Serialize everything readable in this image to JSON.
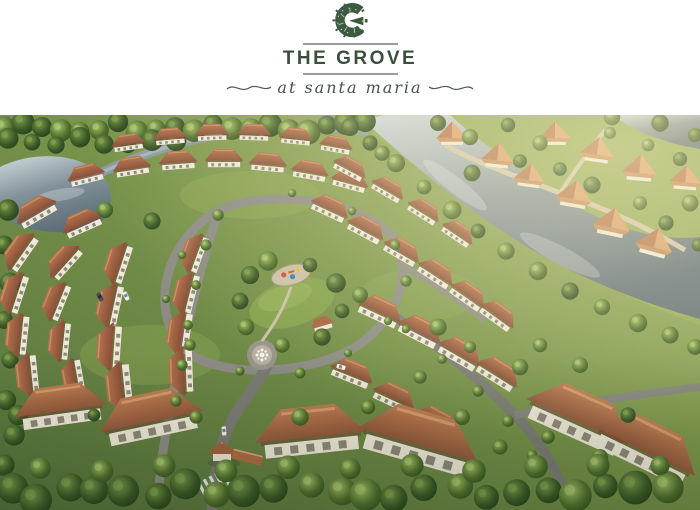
{
  "brand": {
    "logo_letter": "G",
    "name": "THE GROVE",
    "tagline": "at santa maria"
  },
  "colors": {
    "brand_green": "#3c5a40",
    "divider_gray": "#95a096",
    "row_roof_terracotta": "#a5684a",
    "estate_roof_orange": "#cd9465",
    "foliage_green": "#55712f",
    "water_gray_blue": "#84939b",
    "road_gray": "#8c8c85",
    "wall_cream": "#efe9da"
  },
  "hero": {
    "description": "Aerial rendering of a gated residential community with rows of terracotta-roofed homes along curving tree-lined streets, a central park with playground, lawn and fountain plaza, an entrance gatehouse with crosswalk, and a winding river separating larger estate homes on the far bank"
  }
}
